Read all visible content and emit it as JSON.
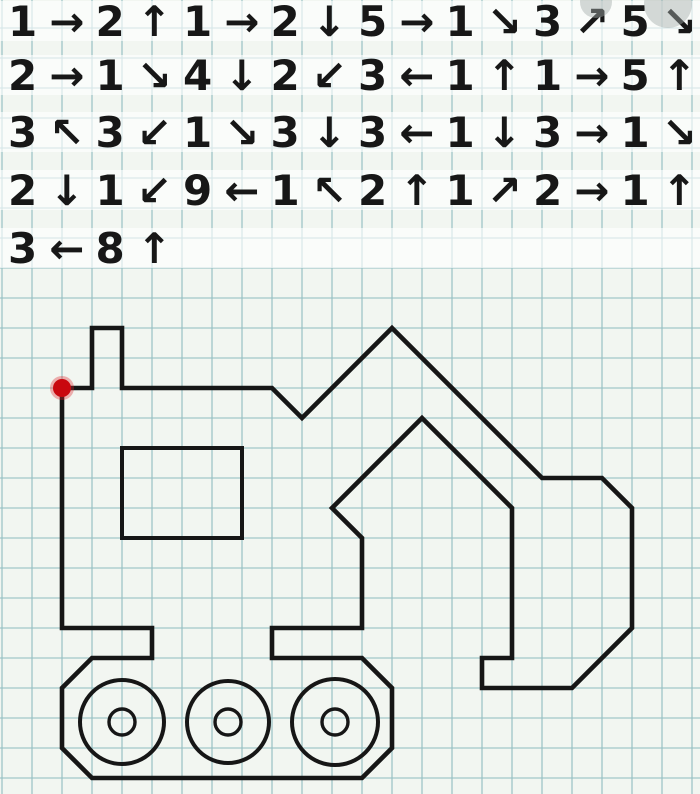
{
  "canvas": {
    "width": 700,
    "height": 794,
    "background_color": "#f2f6f1"
  },
  "grid": {
    "cell_px": 30,
    "first_vline_x": 2,
    "first_hline_y": 28,
    "line_color": "#95c0c3",
    "line_width": 1.35,
    "line_opacity": 0.85
  },
  "instructions": {
    "font_px": 42,
    "text_color": "#171717",
    "first_item_x": 8,
    "item_pitch_px": 87.5,
    "arrow_gap_px": 12,
    "band_fill": "#ffffff",
    "band_opacity": 0.62,
    "band_height_px": 40,
    "rows": [
      {
        "y_center": 21,
        "items": [
          {
            "count": 1,
            "dir": "right"
          },
          {
            "count": 2,
            "dir": "up"
          },
          {
            "count": 1,
            "dir": "right"
          },
          {
            "count": 2,
            "dir": "down"
          },
          {
            "count": 5,
            "dir": "right"
          },
          {
            "count": 1,
            "dir": "down-right"
          },
          {
            "count": 3,
            "dir": "up-right"
          },
          {
            "count": 5,
            "dir": "down-right"
          }
        ]
      },
      {
        "y_center": 75,
        "items": [
          {
            "count": 2,
            "dir": "right"
          },
          {
            "count": 1,
            "dir": "down-right"
          },
          {
            "count": 4,
            "dir": "down"
          },
          {
            "count": 2,
            "dir": "down-left"
          },
          {
            "count": 3,
            "dir": "left"
          },
          {
            "count": 1,
            "dir": "up"
          },
          {
            "count": 1,
            "dir": "right"
          },
          {
            "count": 5,
            "dir": "up"
          }
        ]
      },
      {
        "y_center": 132,
        "items": [
          {
            "count": 3,
            "dir": "up-left"
          },
          {
            "count": 3,
            "dir": "down-left"
          },
          {
            "count": 1,
            "dir": "down-right"
          },
          {
            "count": 3,
            "dir": "down"
          },
          {
            "count": 3,
            "dir": "left"
          },
          {
            "count": 1,
            "dir": "down"
          },
          {
            "count": 3,
            "dir": "right"
          },
          {
            "count": 1,
            "dir": "down-right"
          }
        ]
      },
      {
        "y_center": 190,
        "items": [
          {
            "count": 2,
            "dir": "down"
          },
          {
            "count": 1,
            "dir": "down-left"
          },
          {
            "count": 9,
            "dir": "left"
          },
          {
            "count": 1,
            "dir": "up-left"
          },
          {
            "count": 2,
            "dir": "up"
          },
          {
            "count": 1,
            "dir": "up-right"
          },
          {
            "count": 2,
            "dir": "right"
          },
          {
            "count": 1,
            "dir": "up"
          }
        ]
      },
      {
        "y_center": 248,
        "items": [
          {
            "count": 3,
            "dir": "left"
          },
          {
            "count": 8,
            "dir": "up"
          }
        ]
      }
    ]
  },
  "arrow_glyphs": {
    "up": "↑",
    "down": "↓",
    "left": "←",
    "right": "→",
    "up-left": "↖",
    "up-right": "↗",
    "down-left": "↙",
    "down-right": "↘"
  },
  "figure": {
    "origin_px": {
      "x": 62,
      "y": 388
    },
    "cell_px": 30,
    "stroke_color": "#161616",
    "outline_width": 4.6,
    "outline_cells": [
      [
        0,
        0
      ],
      [
        1,
        0
      ],
      [
        1,
        -2
      ],
      [
        2,
        -2
      ],
      [
        2,
        0
      ],
      [
        7,
        0
      ],
      [
        8,
        1
      ],
      [
        11,
        -2
      ],
      [
        16,
        3
      ],
      [
        18,
        3
      ],
      [
        19,
        4
      ],
      [
        19,
        8
      ],
      [
        17,
        10
      ],
      [
        14,
        10
      ],
      [
        14,
        9
      ],
      [
        15,
        9
      ],
      [
        15,
        4
      ],
      [
        12,
        1
      ],
      [
        9,
        4
      ],
      [
        10,
        5
      ],
      [
        10,
        8
      ],
      [
        7,
        8
      ],
      [
        7,
        9
      ],
      [
        10,
        9
      ],
      [
        11,
        10
      ],
      [
        11,
        12
      ],
      [
        10,
        13
      ],
      [
        1,
        13
      ],
      [
        0,
        12
      ],
      [
        0,
        10
      ],
      [
        1,
        9
      ],
      [
        3,
        9
      ],
      [
        3,
        8
      ],
      [
        0,
        8
      ]
    ],
    "window": {
      "cell_x": 2,
      "cell_y": 2,
      "cell_w": 4,
      "cell_h": 3,
      "stroke_width": 4
    },
    "wheels": [
      {
        "cx": 122,
        "cy": 722,
        "outer_r": 42,
        "inner_r": 13
      },
      {
        "cx": 228,
        "cy": 722,
        "outer_r": 41,
        "inner_r": 13
      },
      {
        "cx": 335,
        "cy": 722,
        "outer_r": 43,
        "inner_r": 13
      }
    ],
    "wheel_stroke_width": 4,
    "start_dot": {
      "cell_x": 0,
      "cell_y": 0,
      "radius": 9,
      "color": "#c9080f",
      "glow_color": "#e0262a"
    }
  },
  "watermark": {
    "fill": "#a3adab",
    "opacity": 0.45,
    "blobs": [
      {
        "cx": 596,
        "cy": 2,
        "r": 16
      },
      {
        "cx": 668,
        "cy": 4,
        "r": 24
      }
    ]
  }
}
